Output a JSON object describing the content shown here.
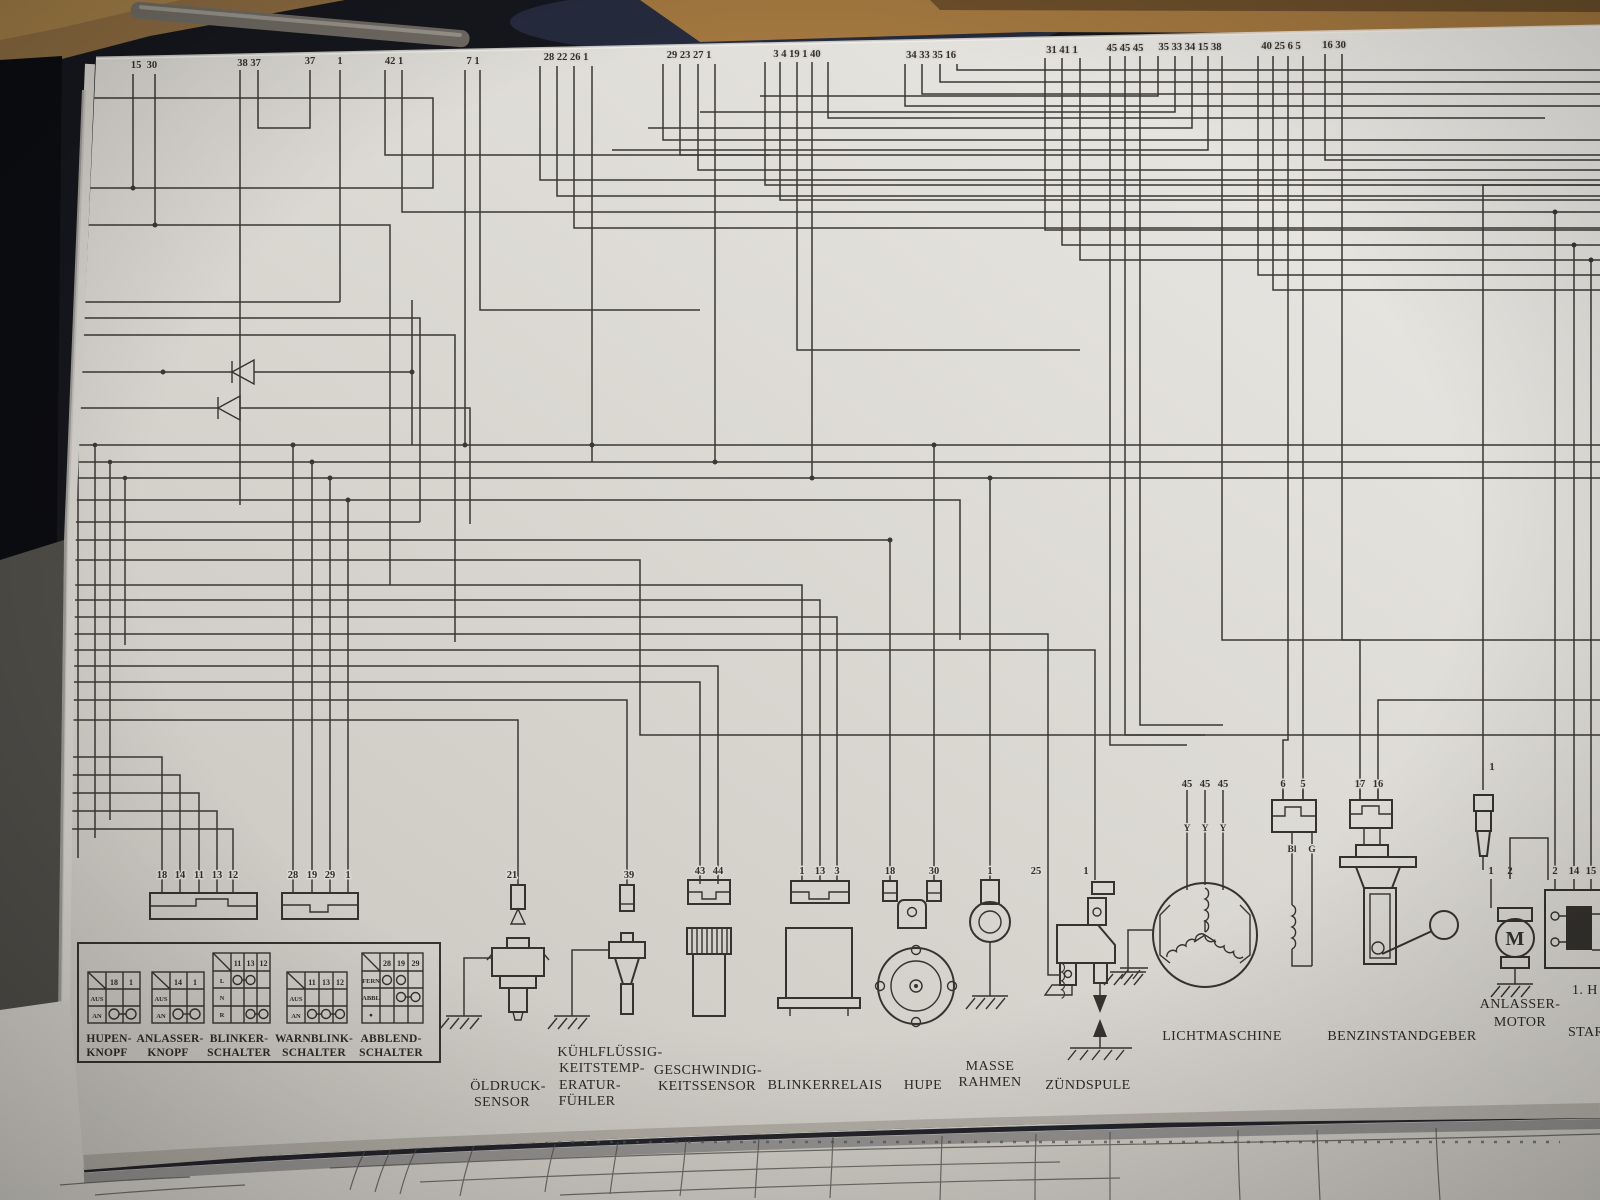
{
  "colors": {
    "paper": "#dcd9d3",
    "ink": "#3a3734",
    "background": "#14161c",
    "wood": "#a2773f"
  },
  "top_pin_groups": [
    {
      "labels": [
        "15",
        "30"
      ]
    },
    {
      "labels": [
        "38",
        "37"
      ]
    },
    {
      "labels": [
        "37"
      ]
    },
    {
      "labels": [
        "1"
      ]
    },
    {
      "labels": [
        "42",
        "1"
      ]
    },
    {
      "labels": [
        "7",
        "1"
      ]
    },
    {
      "labels": [
        "28",
        "22",
        "26",
        "1"
      ]
    },
    {
      "labels": [
        "29",
        "23",
        "27",
        "1"
      ]
    },
    {
      "labels": [
        "3",
        "4",
        "19",
        "1",
        "40"
      ]
    },
    {
      "labels": [
        "34",
        "33",
        "35",
        "16"
      ]
    },
    {
      "labels": [
        "31",
        "41",
        "1"
      ]
    },
    {
      "labels": [
        "45",
        "45",
        "45"
      ]
    },
    {
      "labels": [
        "35",
        "33",
        "34",
        "15",
        "38"
      ]
    },
    {
      "labels": [
        "40",
        "25",
        "6",
        "5"
      ]
    },
    {
      "labels": [
        "16",
        "30"
      ]
    }
  ],
  "bottom_connectors": [
    {
      "pins": [
        "18",
        "14",
        "11",
        "13",
        "12"
      ]
    },
    {
      "pins": [
        "28",
        "19",
        "29",
        "1"
      ]
    }
  ],
  "switch_panel": {
    "tables": [
      {
        "name": "hupen-knopf",
        "label_lines": [
          "HUPEN-",
          "KNOPF"
        ],
        "columns": [
          "18",
          "1"
        ],
        "rows": [
          {
            "label": "AUS",
            "contacts": []
          },
          {
            "label": "AN",
            "contacts": [
              0,
              1
            ]
          }
        ]
      },
      {
        "name": "anlasser-knopf",
        "label_lines": [
          "ANLASSER-",
          "KNOPF"
        ],
        "columns": [
          "14",
          "1"
        ],
        "rows": [
          {
            "label": "AUS",
            "contacts": []
          },
          {
            "label": "AN",
            "contacts": [
              0,
              1
            ]
          }
        ]
      },
      {
        "name": "blinker-schalter",
        "label_lines": [
          "BLINKER-",
          "SCHALTER"
        ],
        "columns": [
          "11",
          "13",
          "12"
        ],
        "rows": [
          {
            "label": "L",
            "contacts": [
              0,
              1
            ]
          },
          {
            "label": "N",
            "contacts": []
          },
          {
            "label": "R",
            "contacts": [
              1,
              2
            ]
          }
        ]
      },
      {
        "name": "warnblink-schalter",
        "label_lines": [
          "WARNBLINK-",
          "SCHALTER"
        ],
        "columns": [
          "11",
          "13",
          "12"
        ],
        "rows": [
          {
            "label": "AUS",
            "contacts": []
          },
          {
            "label": "AN",
            "contacts": [
              0,
              1,
              2
            ]
          }
        ]
      },
      {
        "name": "abblend-schalter",
        "label_lines": [
          "ABBLEND-",
          "SCHALTER"
        ],
        "columns": [
          "28",
          "19",
          "29"
        ],
        "rows": [
          {
            "label": "FERN",
            "contacts": [
              0,
              1
            ]
          },
          {
            "label": "ABBL",
            "contacts": [
              1,
              2
            ]
          },
          {
            "label": "●",
            "contacts": []
          }
        ]
      }
    ]
  },
  "components": [
    {
      "name": "oeldruck-sensor",
      "pins": [
        "21"
      ],
      "label_lines": [
        "ÖLDRUCK-",
        "SENSOR"
      ]
    },
    {
      "name": "kuehlfluessigkeits-temperatur-fuehler",
      "pins": [
        "39"
      ],
      "label_lines": [
        "KÜHLFLÜSSIG-",
        "KEITSTEMP-",
        "ERATUR-",
        "FÜHLER"
      ]
    },
    {
      "name": "geschwindigkeitssensor",
      "pins": [
        "43",
        "44"
      ],
      "label_lines": [
        "GESCHWINDIG-",
        "KEITSSENSOR"
      ]
    },
    {
      "name": "blinkerrelais",
      "pins": [
        "1",
        "13",
        "3"
      ],
      "label_lines": [
        "BLINKERRELAIS"
      ]
    },
    {
      "name": "hupe",
      "pins": [
        "18",
        "30"
      ],
      "label_lines": [
        "HUPE"
      ]
    },
    {
      "name": "masse-rahmen",
      "pins": [
        "1"
      ],
      "label_lines": [
        "MASSE",
        "RAHMEN"
      ]
    },
    {
      "name": "zuendspule",
      "pins": [
        "25",
        "1"
      ],
      "label_lines": [
        "ZÜNDSPULE"
      ]
    },
    {
      "name": "lichtmaschine",
      "pins": [
        "45",
        "45",
        "45"
      ],
      "wire_labels": [
        "Y",
        "Y",
        "Y"
      ],
      "label_lines": [
        "LICHTMASCHINE"
      ]
    },
    {
      "name": "regler-stecker",
      "pins": [
        "6",
        "5"
      ],
      "wire_labels": [
        "Bl",
        "G"
      ],
      "label_lines": []
    },
    {
      "name": "benzinstandgeber",
      "pins": [
        "17",
        "16"
      ],
      "label_lines": [
        "BENZINSTANDGEBER"
      ]
    },
    {
      "name": "anlasser-motor",
      "feed_pin": "1",
      "pins": [
        "1",
        "2"
      ],
      "symbol_letter": "M",
      "label_lines": [
        "ANLASSER-",
        "MOTOR"
      ]
    },
    {
      "name": "starterrelais",
      "pins": [
        "2",
        "14",
        "15"
      ],
      "label_lines": [
        "1. H",
        "STAR"
      ]
    }
  ]
}
